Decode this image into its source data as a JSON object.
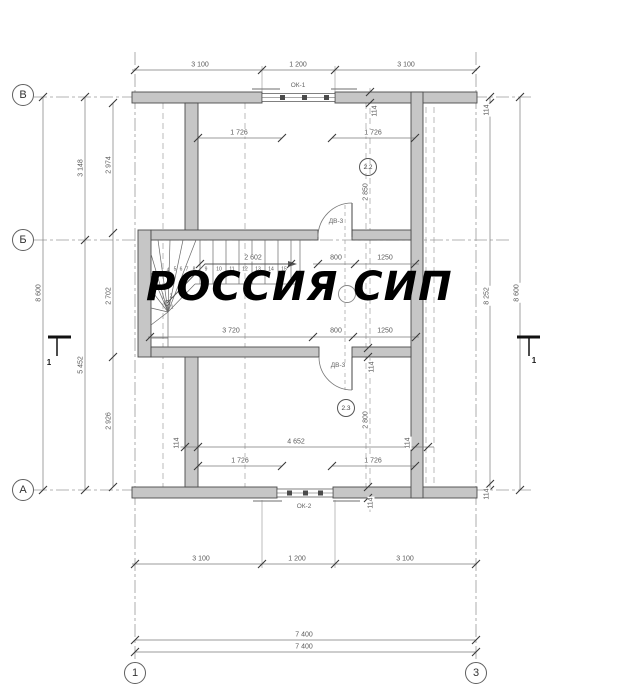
{
  "watermark": {
    "text": "РОССИЯ СИП"
  },
  "colors": {
    "wall_fill": "#c6c6c6",
    "wall_edge": "#4b4b4b",
    "dim_line": "#777777",
    "dim_text": "#5a5a5a",
    "axis_line": "#999999",
    "watermark": "#000000"
  },
  "axis_circles": [
    {
      "label": "В",
      "x": 23,
      "y": 95
    },
    {
      "label": "Б",
      "x": 23,
      "y": 240
    },
    {
      "label": "А",
      "x": 23,
      "y": 490
    },
    {
      "label": "1",
      "x": 135,
      "y": 673
    },
    {
      "label": "3",
      "x": 476,
      "y": 673
    }
  ],
  "section_labels": [
    {
      "t": "1",
      "x": 49,
      "y": 363
    },
    {
      "t": "1",
      "x": 534,
      "y": 361
    }
  ],
  "room_tags": [
    {
      "label": "2.2",
      "x": 368,
      "y": 167
    },
    {
      "label": "2.3",
      "x": 346,
      "y": 408
    }
  ],
  "opening_labels": [
    {
      "t": "ОК-1",
      "x": 298,
      "y": 86
    },
    {
      "t": "ОК-2",
      "x": 304,
      "y": 507
    },
    {
      "t": "ДВ-3",
      "x": 336,
      "y": 222
    },
    {
      "t": "ДВ-3",
      "x": 338,
      "y": 366
    }
  ],
  "dimensions": [
    {
      "t": "3 100",
      "x": 200,
      "y": 65
    },
    {
      "t": "1 200",
      "x": 298,
      "y": 65
    },
    {
      "t": "3 100",
      "x": 406,
      "y": 65
    },
    {
      "t": "1 726",
      "x": 239,
      "y": 133
    },
    {
      "t": "1 726",
      "x": 373,
      "y": 133
    },
    {
      "t": "114",
      "x": 375,
      "y": 111,
      "r": -90
    },
    {
      "t": "2 850",
      "x": 366,
      "y": 192,
      "r": -90
    },
    {
      "t": "2 602",
      "x": 253,
      "y": 258
    },
    {
      "t": "800",
      "x": 336,
      "y": 258
    },
    {
      "t": "1250",
      "x": 385,
      "y": 258
    },
    {
      "t": "3 720",
      "x": 231,
      "y": 331
    },
    {
      "t": "800",
      "x": 336,
      "y": 331
    },
    {
      "t": "1250",
      "x": 385,
      "y": 331
    },
    {
      "t": "114",
      "x": 372,
      "y": 367,
      "r": -90
    },
    {
      "t": "2 800",
      "x": 366,
      "y": 420,
      "r": -90
    },
    {
      "t": "114",
      "x": 177,
      "y": 443,
      "r": -90
    },
    {
      "t": "4 652",
      "x": 296,
      "y": 442
    },
    {
      "t": "114",
      "x": 408,
      "y": 443,
      "r": -90
    },
    {
      "t": "1 726",
      "x": 240,
      "y": 461
    },
    {
      "t": "1 726",
      "x": 373,
      "y": 461
    },
    {
      "t": "114",
      "x": 371,
      "y": 503,
      "r": -90
    },
    {
      "t": "8 600",
      "x": 39,
      "y": 293,
      "r": -90
    },
    {
      "t": "3 148",
      "x": 81,
      "y": 168,
      "r": -90
    },
    {
      "t": "5 452",
      "x": 81,
      "y": 365,
      "r": -90
    },
    {
      "t": "2 974",
      "x": 109,
      "y": 165,
      "r": -90
    },
    {
      "t": "2 702",
      "x": 109,
      "y": 296,
      "r": -90
    },
    {
      "t": "2 926",
      "x": 109,
      "y": 421,
      "r": -90
    },
    {
      "t": "114",
      "x": 487,
      "y": 110,
      "r": -90
    },
    {
      "t": "8 252",
      "x": 487,
      "y": 296,
      "r": -90
    },
    {
      "t": "114",
      "x": 487,
      "y": 494,
      "r": -90
    },
    {
      "t": "8 600",
      "x": 517,
      "y": 293,
      "r": -90
    },
    {
      "t": "3 100",
      "x": 201,
      "y": 559
    },
    {
      "t": "1 200",
      "x": 297,
      "y": 559
    },
    {
      "t": "3 100",
      "x": 405,
      "y": 559
    },
    {
      "t": "7 400",
      "x": 304,
      "y": 635
    },
    {
      "t": "7 400",
      "x": 304,
      "y": 647
    }
  ],
  "stair_numbers": [
    {
      "t": "1",
      "x": 172,
      "y": 308
    },
    {
      "t": "2",
      "x": 171,
      "y": 297
    },
    {
      "t": "3",
      "x": 170,
      "y": 286
    },
    {
      "t": "4",
      "x": 168,
      "y": 271
    },
    {
      "t": "5",
      "x": 175,
      "y": 270
    },
    {
      "t": "6",
      "x": 181,
      "y": 270
    },
    {
      "t": "7",
      "x": 187,
      "y": 270
    },
    {
      "t": "8",
      "x": 194,
      "y": 270
    },
    {
      "t": "9",
      "x": 206,
      "y": 270
    },
    {
      "t": "10",
      "x": 219,
      "y": 270
    },
    {
      "t": "11",
      "x": 232,
      "y": 270
    },
    {
      "t": "12",
      "x": 245,
      "y": 270
    },
    {
      "t": "13",
      "x": 258,
      "y": 270
    },
    {
      "t": "14",
      "x": 271,
      "y": 270
    },
    {
      "t": "15",
      "x": 284,
      "y": 270
    }
  ]
}
